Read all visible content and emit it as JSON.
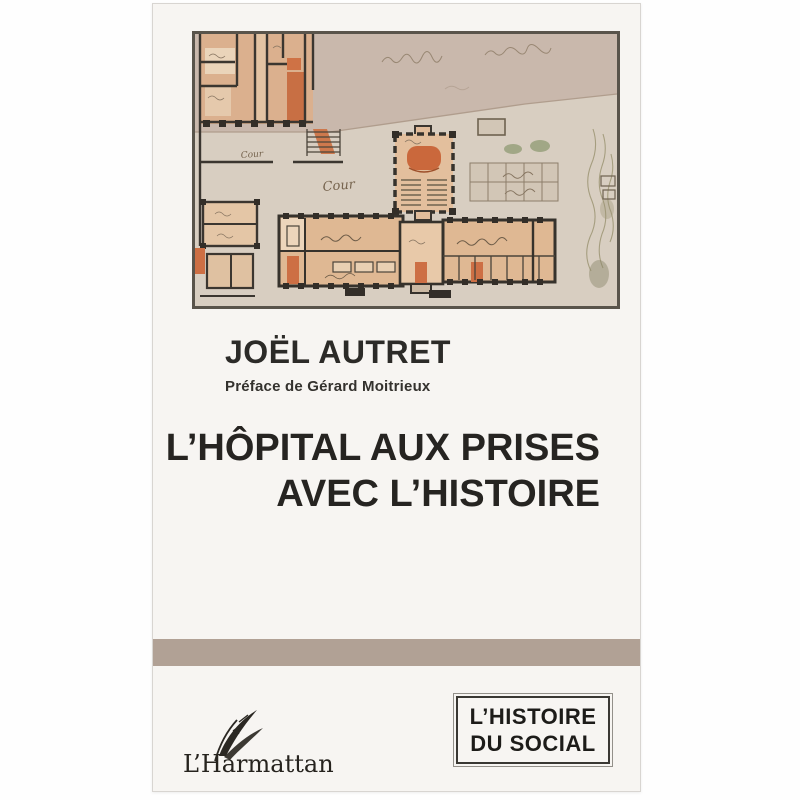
{
  "cover": {
    "background_color": "#f7f5f2",
    "band_color": "#b1a195",
    "author": "JOËL AUTRET",
    "preface": "Préface de Gérard Moitrieux",
    "title": {
      "line1": "L’HÔPITAL AUX PRISES",
      "line2": "AVEC L’HISTOIRE"
    },
    "publisher": {
      "name": "L’Harmattan"
    },
    "collection": {
      "line1": "L’HISTOIRE",
      "line2": "DU SOCIAL"
    }
  },
  "plan": {
    "description": "Old watercolor architectural floor plan of a hospital",
    "labels": {
      "courtyard_small": "Cour",
      "courtyard_large": "Cour"
    },
    "colors": {
      "paper_light": "#d8cec1",
      "paper_dark": "#c9b8ac",
      "room_salmon": "#dfb893",
      "accent_orange": "#cd6f44",
      "wall_ink": "#36322c",
      "frame": "#59544b"
    }
  }
}
